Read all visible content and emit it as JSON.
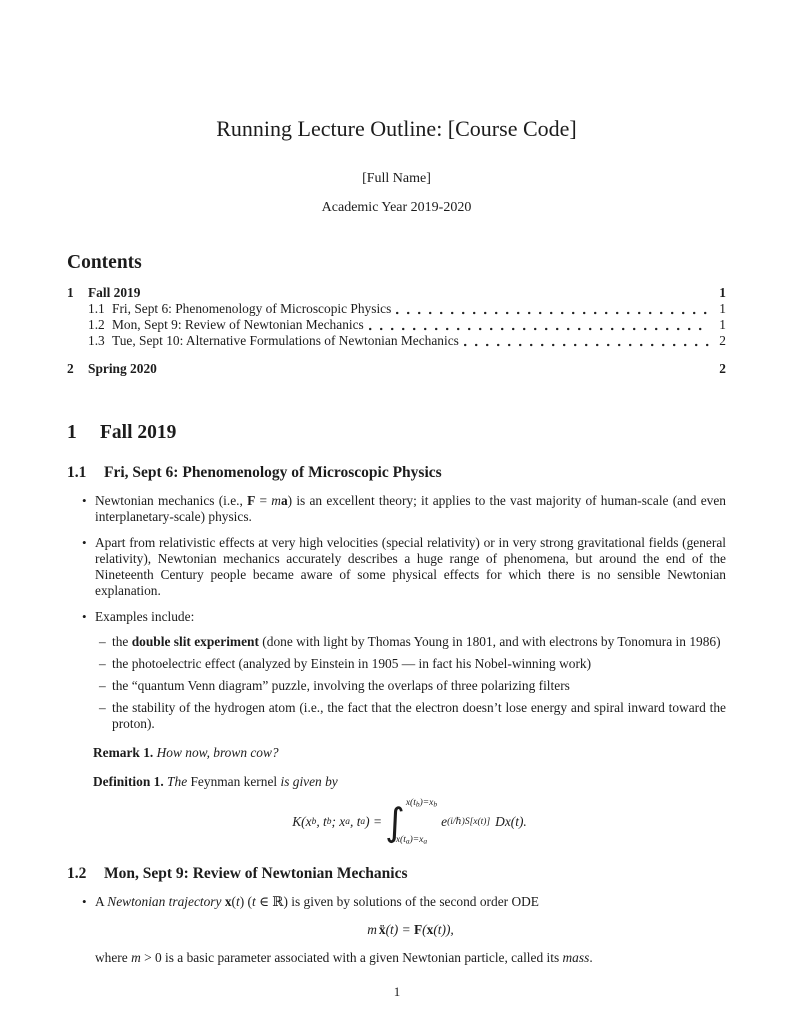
{
  "doc": {
    "title": "Running Lecture Outline: [Course Code]",
    "author": "[Full Name]",
    "date": "Academic Year 2019-2020",
    "page_number": "1"
  },
  "toc": {
    "heading": "Contents",
    "entries": [
      {
        "number": "1",
        "label": "Fall 2019",
        "page": "1"
      },
      {
        "number": "1.1",
        "label": "Fri, Sept 6: Phenomenology of Microscopic Physics",
        "page": "1"
      },
      {
        "number": "1.2",
        "label": "Mon, Sept 9: Review of Newtonian Mechanics",
        "page": "1"
      },
      {
        "number": "1.3",
        "label": "Tue, Sept 10: Alternative Formulations of Newtonian Mechanics",
        "page": "2"
      },
      {
        "number": "2",
        "label": "Spring 2020",
        "page": "2"
      }
    ]
  },
  "section_fall": {
    "number": "1",
    "title": "Fall 2019"
  },
  "sub_phenomenology": {
    "number": "1.1",
    "title": "Fri, Sept 6: Phenomenology of Microscopic Physics"
  },
  "bullets_11": {
    "b1": {
      "t1": "Newtonian mechanics (i.e., ",
      "F": "F",
      "t2": " = ",
      "m": "m",
      "a": "a",
      "t3": ") is an excellent theory; it applies to the vast majority of human-scale (and even interplanetary-scale) physics."
    },
    "b2": {
      "text": "Apart from relativistic effects at very high velocities (special relativity) or in very strong gravitational fields (general relativity), Newtonian mechanics accurately describes a huge range of phenomena, but around the end of the Nineteenth Century people became aware of some physical effects for which there is no sensible Newtonian explanation."
    },
    "b3": {
      "text": "Examples include:"
    },
    "sub1": {
      "t1": "the ",
      "bold": "double slit experiment",
      "t2": " (done with light by Thomas Young in 1801, and with electrons by Tonomura in 1986)"
    },
    "sub2": {
      "text": "the photoelectric effect (analyzed by Einstein in 1905 — in fact his Nobel-winning work)"
    },
    "sub3": {
      "text": "the “quantum Venn diagram” puzzle, involving the overlaps of three polarizing filters"
    },
    "sub4": {
      "text": "the stability of the hydrogen atom (i.e., the fact that the electron doesn’t lose energy and spiral inward toward the proton)."
    }
  },
  "remark": {
    "label": "Remark 1.",
    "text": "How now, brown cow?"
  },
  "definition": {
    "label": "Definition 1.",
    "t1": "The ",
    "term": "Feynman kernel",
    "t2": " is given by"
  },
  "eq_feynman": {
    "plain": "K(x_b, t_b; x_a, t_a) = ∫_{x(t_a)=x_a}^{x(t_b)=x_b} e^{(i/ℏ)S[x(t)]} Dx(t).",
    "lhs1": "K(x",
    "sub1": "b",
    "lhs2": ", t",
    "sub2": "b",
    "lhs3": "; x",
    "sub3": "a",
    "lhs4": ", t",
    "sub4": "a",
    "lhs5": ") = ",
    "int": "∫",
    "up1": "x(t",
    "up_s1": "b",
    "up2": ")=x",
    "up_s2": "b",
    "lo1": "x(t",
    "lo_s1": "a",
    "lo2": ")=x",
    "lo_s2": "a",
    "base": "e",
    "exp": "(i/ℏ)S[x(t)]",
    "measure": "D",
    "tail": "x(t)."
  },
  "sub_newtonian": {
    "number": "1.2",
    "title": "Mon, Sept 9: Review of Newtonian Mechanics"
  },
  "bullets_12": {
    "b1": {
      "t1": "A ",
      "em": "Newtonian trajectory ",
      "x": "x",
      "t2": "(",
      "it1": "t",
      "t3": ") (",
      "it2": "t",
      "t4": " ∈ ℝ) is given by solutions of the second order ODE"
    },
    "where": {
      "t1": "where ",
      "m": "m",
      "t2": " > 0 is a basic parameter associated with a given Newtonian particle, called its ",
      "em": "mass",
      "t3": "."
    }
  },
  "eq_newton": {
    "plain": "m ẍ(t) = F(x(t)),",
    "m": "m",
    "xdd": "ẍ",
    "t1": "(t) = ",
    "F": "F",
    "t2": "(",
    "x": "x",
    "t3": "(t)),"
  }
}
